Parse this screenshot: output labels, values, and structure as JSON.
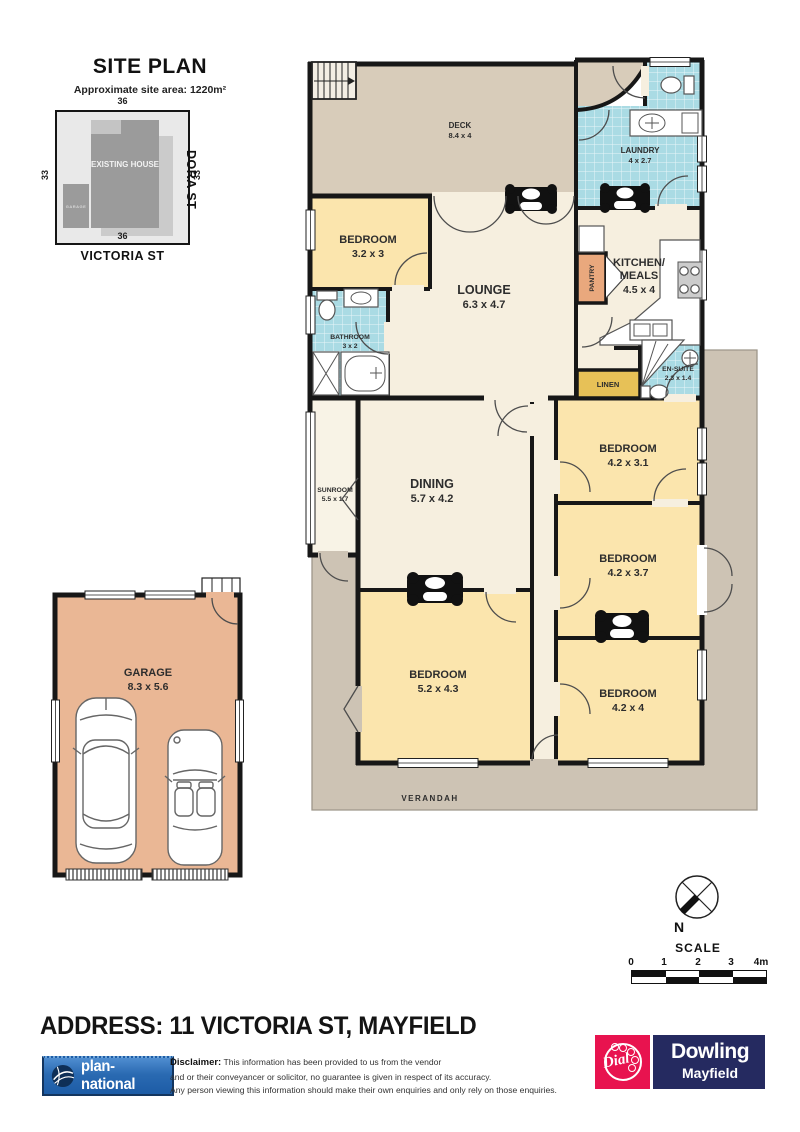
{
  "site_plan": {
    "title": "SITE PLAN",
    "subtitle": "Approximate site area: 1220m²",
    "dim_top": "36",
    "dim_left": "33",
    "dim_right": "33",
    "dim_bottom": "36",
    "street_right": "DORA ST",
    "street_bottom": "VICTORIA ST",
    "existing_house": "EXISTING HOUSE",
    "garage_label": "GARAGE"
  },
  "floor_plan": {
    "rooms": {
      "deck": {
        "name": "DECK",
        "dims": "8.4 x 4"
      },
      "laundry": {
        "name": "LAUNDRY",
        "dims": "4 x 2.7"
      },
      "bedroom1": {
        "name": "BEDROOM",
        "dims": "3.2 x 3"
      },
      "lounge": {
        "name": "LOUNGE",
        "dims": "6.3 x 4.7"
      },
      "kitchen": {
        "line1": "KITCHEN/",
        "line2": "MEALS",
        "dims": "4.5 x 4"
      },
      "bathroom": {
        "name": "BATHROOM",
        "dims": "3 x 2"
      },
      "pantry": {
        "name": "PANTRY"
      },
      "linen": {
        "name": "LINEN"
      },
      "ensuite": {
        "name": "EN-SUITE",
        "dims": "2.3 x 1.4"
      },
      "sunroom": {
        "name": "SUNROOM",
        "dims": "5.5 x 1.7"
      },
      "dining": {
        "name": "DINING",
        "dims": "5.7 x 4.2"
      },
      "bedroom2": {
        "name": "BEDROOM",
        "dims": "4.2 x 3.1"
      },
      "bedroom3": {
        "name": "BEDROOM",
        "dims": "4.2 x 3.7"
      },
      "bedroom4": {
        "name": "BEDROOM",
        "dims": "5.2 x 4.3"
      },
      "bedroom5": {
        "name": "BEDROOM",
        "dims": "4.2 x 4"
      },
      "verandah": {
        "name": "VERANDAH"
      }
    },
    "garage": {
      "name": "GARAGE",
      "dims": "8.3 x 5.6"
    }
  },
  "compass": {
    "north": "N"
  },
  "scale": {
    "title": "SCALE",
    "ticks": [
      "0",
      "1",
      "2",
      "3",
      "4m"
    ]
  },
  "address": "ADDRESS: 11 VICTORIA ST, MAYFIELD",
  "footer": {
    "brand": "plan-national",
    "disclaimer_label": "Disclaimer:",
    "disclaimer_line1": "This information has been provided to us from the vendor",
    "disclaimer_line2": "and or their conveyancer or solicitor, no guarantee is given in respect of its accuracy.",
    "disclaimer_line3": "Any person viewing this information should make their own enquiries and only rely on those enquiries.",
    "agency": {
      "dial": "Dial",
      "name": "Dowling",
      "suburb": "Mayfield"
    }
  },
  "colors": {
    "wall": "#171717",
    "deck": "#d8ccba",
    "verandah": "#cdc3b4",
    "room_cream": "#f6efdf",
    "bedroom_yellow": "#fbe5ad",
    "tile_blue": "#aadbe4",
    "pantry_salmon": "#e9a87d",
    "linen_gold": "#e7c157",
    "garage_salmon": "#eab795",
    "brand_blue": "#2a6ab2",
    "agency_navy": "#252a60",
    "agency_pink": "#e8134f"
  }
}
